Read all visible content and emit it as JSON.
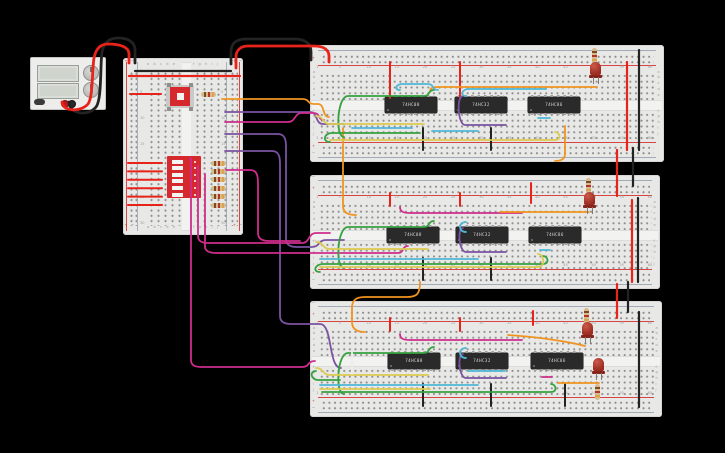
{
  "scene": {
    "background": "#000000",
    "description": "Breadboard logic-gate circuit with power supply, input board and three gate breadboards"
  },
  "palette": {
    "wire_red": "#e8231a",
    "wire_black": "#232323",
    "wire_orange": "#f0941f",
    "wire_yellow": "#ddca50",
    "wire_green": "#36a13f",
    "wire_cyan": "#4fb8d6",
    "wire_purple": "#7b52a1",
    "wire_magenta": "#ce2d8c",
    "wire_white": "#ececec",
    "board_body": "#e8e8e6",
    "board_channel": "#f2f2f0",
    "board_dot": "#8f8f8f",
    "rail_red": "#d64541",
    "rail_blue": "#5b6b85",
    "ic_body": "#2a2a2a",
    "ic_pin": "#a0a0a0",
    "ic_label": "#d8d8d8",
    "led_body": "#9c2b20",
    "resistor_body": "#d8b98d",
    "component_red": "#d6292e"
  },
  "wire_colors_used": [
    "red",
    "black",
    "orange",
    "yellow",
    "green",
    "cyan",
    "purple",
    "magenta",
    "white"
  ],
  "power_supply": {
    "name": "power-supply",
    "display_top": "",
    "display_bottom": "",
    "knobs": [
      "voltage-knob",
      "current-knob"
    ],
    "terminal_positive": "red",
    "terminal_negative": "black"
  },
  "input_breadboard": {
    "name": "input-breadboard",
    "letters_left_bank": "a b c d e",
    "letters_right_bank": "f g h i j",
    "row_numbers": [
      "1",
      "5",
      "10",
      "15",
      "20",
      "25",
      "30"
    ],
    "plus": "+",
    "minus": "−",
    "components": {
      "pushbutton": "pushbutton",
      "dip_switch": "dip-switch-6",
      "dip_positions": 6,
      "pulldown_resistors": 6,
      "pullup_resistor": 1
    }
  },
  "boards": [
    {
      "name": "breadboard-1",
      "ics": [
        {
          "label": "74HC08"
        },
        {
          "label": "74HC32"
        },
        {
          "label": "74HC86"
        }
      ],
      "leds": [
        {
          "color": "red"
        }
      ]
    },
    {
      "name": "breadboard-2",
      "ics": [
        {
          "label": "74HC08"
        },
        {
          "label": "74HC32"
        },
        {
          "label": "74HC86"
        }
      ],
      "leds": [
        {
          "color": "red"
        }
      ]
    },
    {
      "name": "breadboard-3",
      "ics": [
        {
          "label": "74HC08"
        },
        {
          "label": "74HC32"
        },
        {
          "label": "74HC86"
        }
      ],
      "leds": [
        {
          "color": "red"
        },
        {
          "color": "red"
        }
      ]
    }
  ],
  "board_labels": {
    "row_letters_top": [
      "a",
      "b",
      "c",
      "d",
      "e"
    ],
    "row_letters_bottom": [
      "f",
      "g",
      "h",
      "i",
      "j"
    ],
    "column_numbers": [
      "1",
      "5",
      "10",
      "15",
      "20",
      "25",
      "30",
      "35",
      "40",
      "45",
      "50",
      "55",
      "60"
    ],
    "plus": "+",
    "minus": "−"
  }
}
